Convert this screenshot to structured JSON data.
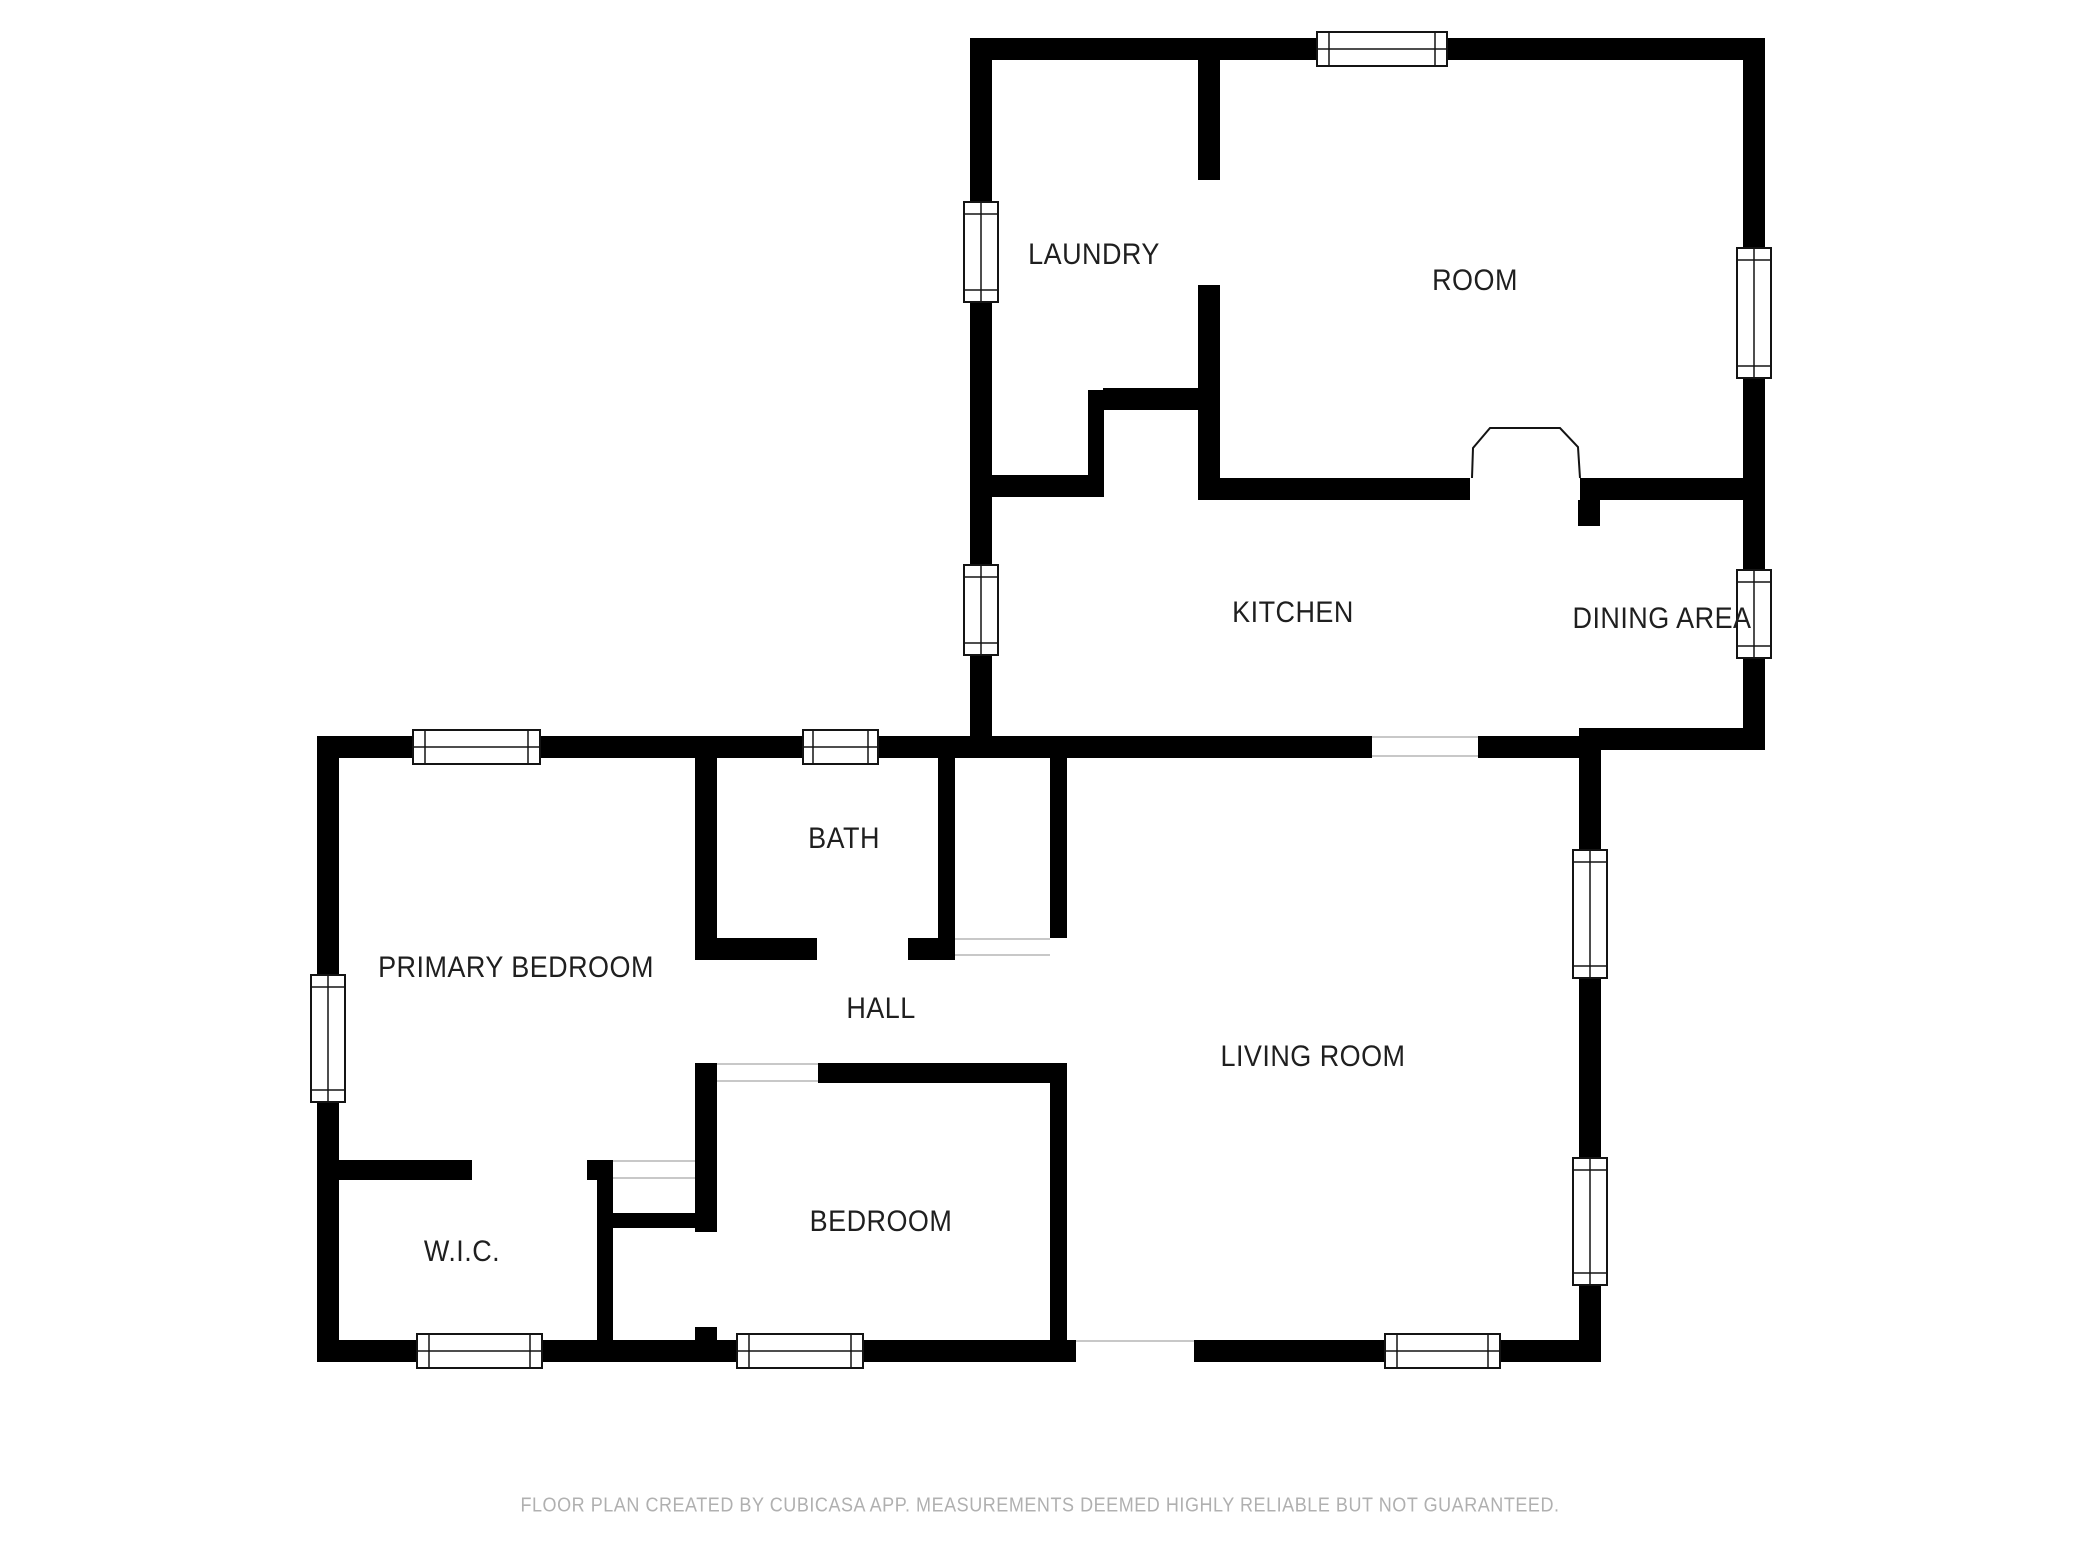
{
  "rooms": {
    "laundry": {
      "label": "LAUNDRY"
    },
    "room": {
      "label": "ROOM"
    },
    "kitchen": {
      "label": "KITCHEN"
    },
    "dining_area": {
      "label": "DINING AREA"
    },
    "primary_bedroom": {
      "label": "PRIMARY BEDROOM"
    },
    "bath": {
      "label": "BATH"
    },
    "hall": {
      "label": "HALL"
    },
    "living_room": {
      "label": "LIVING ROOM"
    },
    "bedroom": {
      "label": "BEDROOM"
    },
    "wic": {
      "label": "W.I.C."
    }
  },
  "footer": {
    "text": "FLOOR PLAN CREATED BY CUBICASA APP. MEASUREMENTS DEEMED HIGHLY RELIABLE BUT NOT GUARANTEED."
  },
  "colors": {
    "wall": "#000000",
    "label_text": "#1f1f1f",
    "footer_text": "#b0b0b0",
    "opening_line": "#c8c8c8",
    "background": "#ffffff"
  }
}
